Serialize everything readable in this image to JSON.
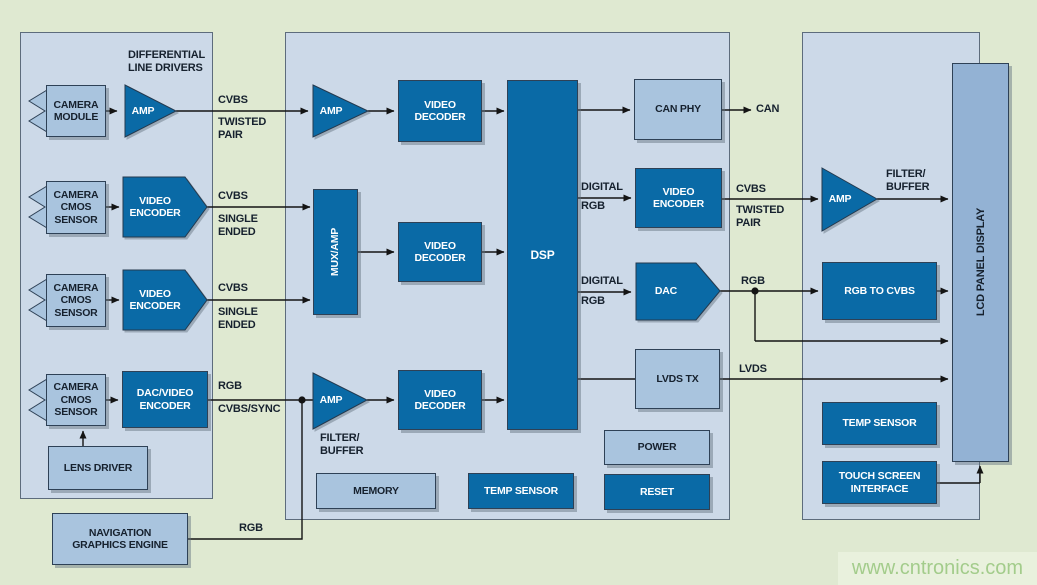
{
  "colors": {
    "background": "#dfe9d1",
    "panel_fill": "#ccd9e8",
    "panel_border": "#5d6c7c",
    "box_light": "#a9c4de",
    "box_dark": "#0a6aa6",
    "lcd_fill": "#93b2d4",
    "wire": "#141414",
    "text_dark": "#16212e",
    "text_light": "#ffffff",
    "watermark_bg": "#e9f1dd",
    "watermark_text": "#a3cc8b"
  },
  "left_panel": {
    "heading": "DIFFERENTIAL\nLINE DRIVERS",
    "camera_module": "CAMERA\nMODULE",
    "camera_cmos": "CAMERA\nCMOS\nSENSOR",
    "amp": "AMP",
    "video_encoder": "VIDEO\nENCODER",
    "dac_video_encoder": "DAC/VIDEO\nENCODER",
    "lens_driver": "LENS DRIVER",
    "navigation": "NAVIGATION\nGRAPHICS ENGINE"
  },
  "middle_panel": {
    "amp": "AMP",
    "mux_amp": "MUX/AMP",
    "video_decoder": "VIDEO\nDECODER",
    "dsp": "DSP",
    "can_phy": "CAN PHY",
    "video_encoder": "VIDEO\nENCODER",
    "dac": "DAC",
    "lvds_tx": "LVDS TX",
    "power": "POWER",
    "reset": "RESET",
    "memory": "MEMORY",
    "temp_sensor": "TEMP SENSOR",
    "filter_buffer": "FILTER/\nBUFFER"
  },
  "right_panel": {
    "amp": "AMP",
    "filter_buffer": "FILTER/\nBUFFER",
    "lcd": "LCD PANEL DISPLAY",
    "rgb_to_cvbs": "RGB TO CVBS",
    "temp_sensor": "TEMP SENSOR",
    "touch_screen": "TOUCH SCREEN\nINTERFACE"
  },
  "wire_labels": {
    "row1_top": "CVBS",
    "row1_bottom": "TWISTED\nPAIR",
    "row2_top": "CVBS",
    "row2_bottom": "SINGLE\nENDED",
    "row3_top": "CVBS",
    "row3_bottom": "SINGLE\nENDED",
    "row4_top": "RGB",
    "row4_bottom": "CVBS/SYNC",
    "nav_rgb": "RGB",
    "can": "CAN",
    "digital_rgb_top": "DIGITAL",
    "digital_rgb_bottom": "RGB",
    "enc_out_top": "CVBS",
    "enc_out_bottom": "TWISTED\nPAIR",
    "dac_out": "RGB",
    "lvds": "LVDS"
  },
  "watermark": "www.cntronics.com"
}
